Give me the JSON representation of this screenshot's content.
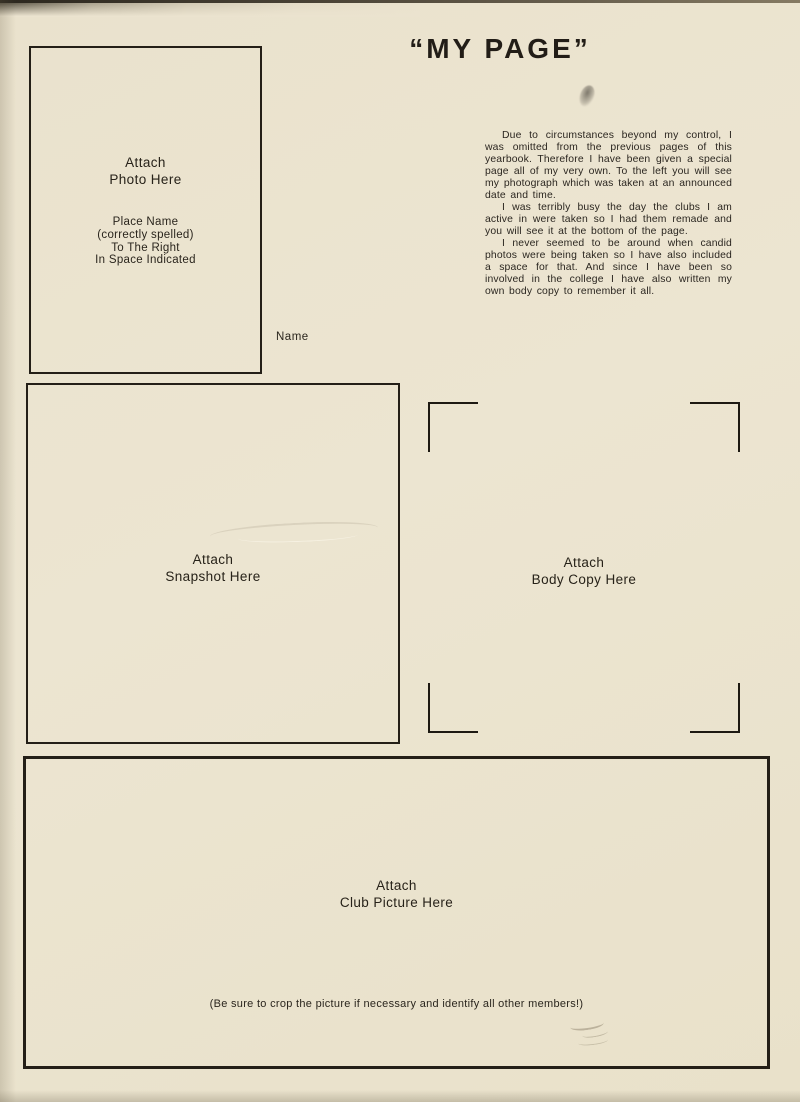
{
  "page": {
    "title": "“MY PAGE”"
  },
  "photo_box": {
    "label_line1": "Attach",
    "label_line2": "Photo Here",
    "instructions": [
      "Place Name",
      "(correctly spelled)",
      "To The Right",
      "In Space Indicated"
    ]
  },
  "name_label": "Name",
  "body_text": {
    "paragraphs": [
      "Due to circumstances beyond my control, I was omitted from the previous pages of this yearbook. Therefore I have been given a special page all of my very own. To the left you will see my photograph which was taken at an announced date and time.",
      "I was terribly busy the day the clubs I am active in were taken so I had them remade and you will see it at the bottom of the page.",
      "I never seemed to be around when candid photos were being taken so I have also included a space for that. And since I have been so involved in the college I have also written my own body copy to remember it all."
    ]
  },
  "snapshot_box": {
    "label_line1": "Attach",
    "label_line2": "Snapshot Here"
  },
  "body_copy_area": {
    "label_line1": "Attach",
    "label_line2": "Body Copy Here"
  },
  "club_box": {
    "label_line1": "Attach",
    "label_line2": "Club Picture Here",
    "caption": "(Be sure to crop the picture if necessary and identify all other members!)"
  },
  "colors": {
    "paper": "#ebe3cf",
    "ink": "#241f17",
    "scan_edge": "#3a3428"
  }
}
